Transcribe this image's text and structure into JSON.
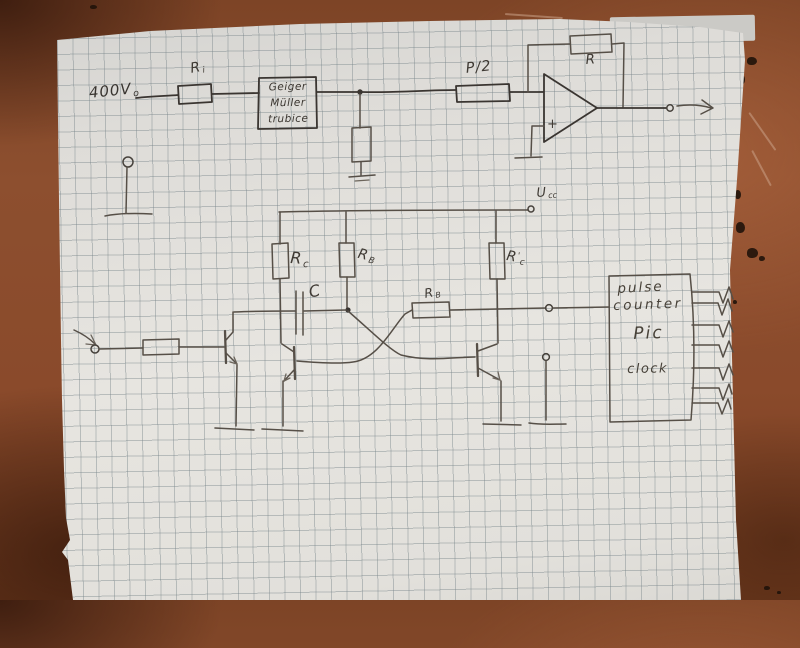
{
  "colors": {
    "table_brown": "#8a4a2c",
    "paper": "#e2e0db",
    "grid_line": "#76838855",
    "pencil": "#46413b"
  },
  "top_circuit": {
    "hv_label": {
      "main": "400V",
      "sub": "o"
    },
    "r1_label": {
      "main": "R",
      "sub": "i"
    },
    "gm_tube": {
      "lines": [
        "Geiger",
        "Müller",
        "trubice"
      ]
    },
    "p2_label": "P/2",
    "feedback_r_label": "R",
    "opamp_plus": "+"
  },
  "lower_circuit": {
    "ucc_label": {
      "main": "U",
      "sub": "cc"
    },
    "rc_left_label": {
      "main": "R",
      "sub": "c"
    },
    "rb_vertical_label": {
      "main": "R",
      "sub": "B"
    },
    "capacitor_label": "C",
    "rb_horizontal_label": {
      "main": "R",
      "sub": "B"
    },
    "rc_right_label": {
      "main": "R",
      "prime": "'",
      "sub": "c"
    },
    "pulse_counter": {
      "lines": [
        "pulse",
        "counter",
        "Pic",
        "clock"
      ]
    }
  }
}
